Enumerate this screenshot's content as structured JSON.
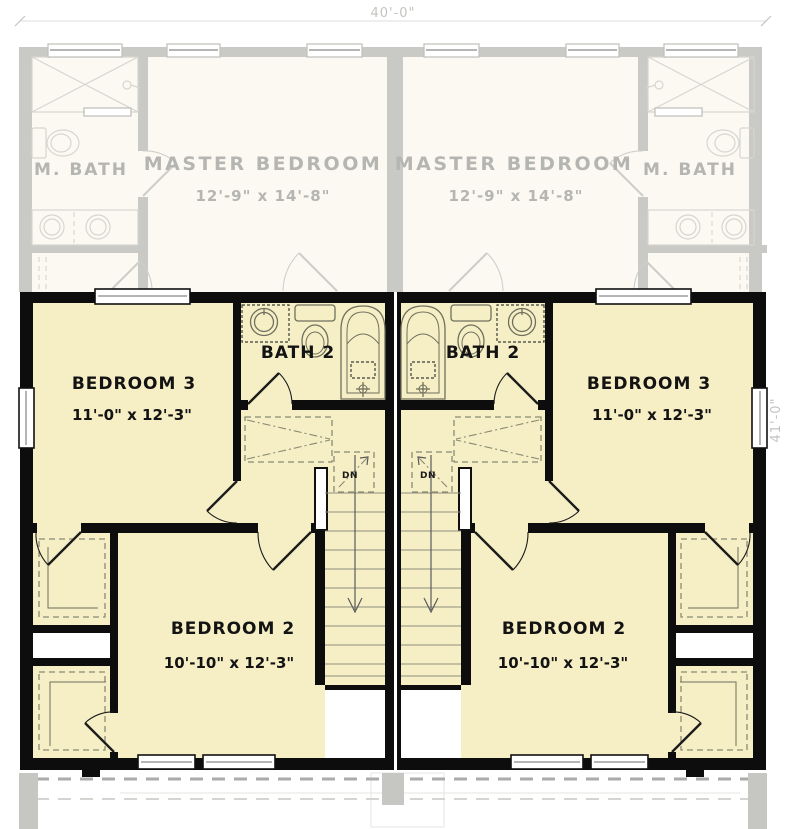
{
  "title": "Duplex second floor plan",
  "dimensions": {
    "width_label": "40'-0\"",
    "height_label": "41'-0\""
  },
  "upper_floor_faded": {
    "left_unit": {
      "bath": "M. BATH",
      "bedroom": "MASTER BEDROOM",
      "bedroom_size": "12'-9\" x 14'-8\""
    },
    "right_unit": {
      "bath": "M. BATH",
      "bedroom": "MASTER BEDROOM",
      "bedroom_size": "12'-9\" x 14'-8\""
    }
  },
  "main_floor": {
    "left_unit": {
      "bedroom3": "BEDROOM 3",
      "bedroom3_size": "11'-0\" x 12'-3\"",
      "bath": "BATH 2",
      "bedroom2": "BEDROOM 2",
      "bedroom2_size": "10'-10\" x 12'-3\"",
      "stair_direction": "DN"
    },
    "right_unit": {
      "bedroom3": "BEDROOM 3",
      "bedroom3_size": "11'-0\" x 12'-3\"",
      "bath": "BATH 2",
      "bedroom2": "BEDROOM 2",
      "bedroom2_size": "10'-10\" x 12'-3\"",
      "stair_direction": "DN"
    }
  },
  "colors": {
    "wall": "#0d0d0d",
    "room_fill": "#f6efc6",
    "fixture": "#6f6f5c",
    "closet_dash": "#8a8a74",
    "tread": "#8d8d7c",
    "faded_wall": "#c9c9c5",
    "faded_fill": "#fbf9f1",
    "faded_line": "#d6d6d0",
    "faded_text": "#b5b5b1",
    "dim_text": "#c3c3bf",
    "site_gray": "#c6c6c2",
    "dash_bold": "#ababab",
    "dash_light": "#d4d4d0"
  }
}
